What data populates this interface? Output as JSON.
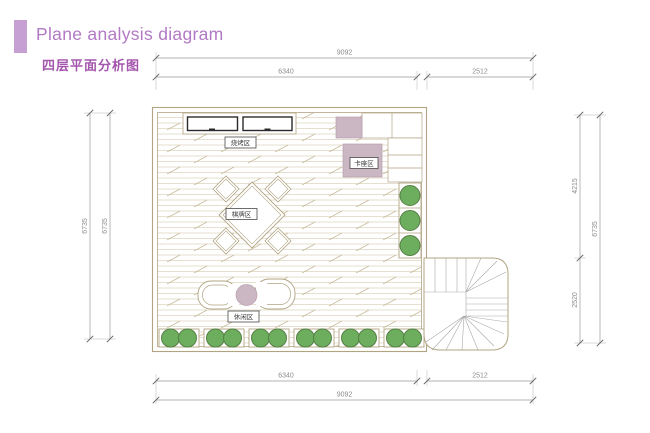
{
  "header": {
    "title": "Plane analysis diagram",
    "subtitle": "四层平面分析图"
  },
  "zones": {
    "bbq": "烧烤区",
    "booth": "卡座区",
    "chess": "棋牌区",
    "leisure": "休闲区"
  },
  "dims": {
    "top_total": "9092",
    "top_left": "6340",
    "top_right": "2512",
    "bottom_left": "6340",
    "bottom_right": "2512",
    "bottom_total": "9092",
    "left_outer": "6735",
    "left_inner": "6735",
    "right_upper": "4215",
    "right_lower": "2520",
    "right_total": "6735"
  },
  "colors": {
    "accent": "#c6a0d3",
    "title": "#b279c4",
    "subtitle": "#a457ad",
    "wall": "#b1a483",
    "pink": "#cbb6c3",
    "green": "#6dae5e",
    "dim": "#9a9a9a"
  }
}
